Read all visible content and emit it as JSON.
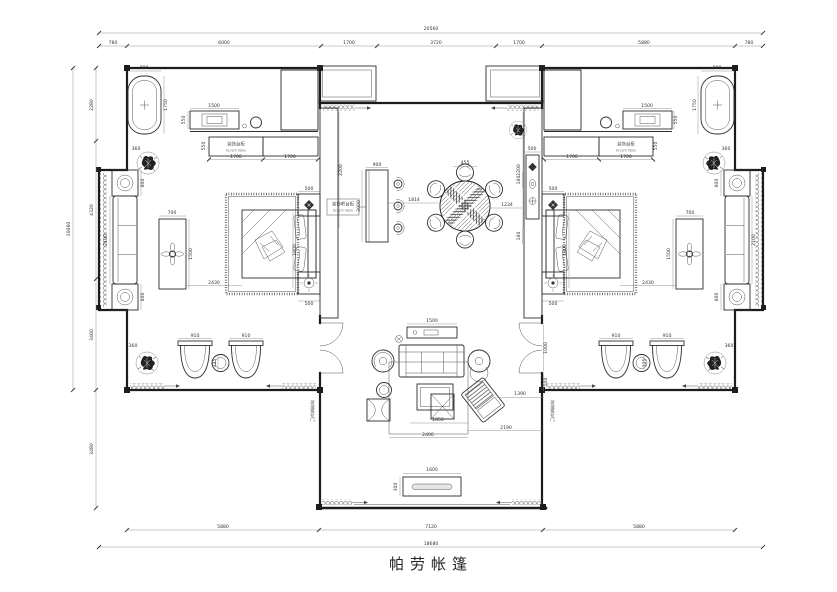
{
  "title": {
    "text": "帕劳帐篷"
  },
  "labels": {
    "accent_table_zh": "装饰台柜",
    "accent_table_en": "Accent Table",
    "bar_zh": "装饰吧台柜",
    "bar_en": "Accent Table",
    "glass_door": "玻璃推拉门"
  },
  "colors": {
    "line": "#1c1c1c",
    "dim_text": "#333333",
    "paper": "#ffffff"
  },
  "dimensions": {
    "top": {
      "total": "20560",
      "segments": [
        "780",
        "6000",
        "1700",
        "3720",
        "1700",
        "5880",
        "780"
      ]
    },
    "bottom": {
      "total": "18680",
      "segments": [
        "5880",
        "7120",
        "5880"
      ]
    },
    "left": {
      "total": "10060",
      "segments": [
        "2280",
        "4320",
        "3460"
      ],
      "lower": "3480"
    }
  },
  "dim_labels": [
    {
      "t": "20560",
      "x": 431,
      "y": 30
    },
    {
      "t": "780",
      "x": 113,
      "y": 44
    },
    {
      "t": "6000",
      "x": 224,
      "y": 44
    },
    {
      "t": "1700",
      "x": 349,
      "y": 44
    },
    {
      "t": "3720",
      "x": 436,
      "y": 44
    },
    {
      "t": "1700",
      "x": 519,
      "y": 44
    },
    {
      "t": "5880",
      "x": 644,
      "y": 44
    },
    {
      "t": "780",
      "x": 749,
      "y": 44
    },
    {
      "t": "5880",
      "x": 223,
      "y": 528
    },
    {
      "t": "7120",
      "x": 431,
      "y": 528
    },
    {
      "t": "5880",
      "x": 639,
      "y": 528
    },
    {
      "t": "18680",
      "x": 431,
      "y": 545
    },
    {
      "t": "2280",
      "x": 93,
      "y": 105,
      "r": 1
    },
    {
      "t": "4320",
      "x": 93,
      "y": 210,
      "r": 1
    },
    {
      "t": "3460",
      "x": 93,
      "y": 335,
      "r": 1
    },
    {
      "t": "10060",
      "x": 70,
      "y": 229,
      "r": 1
    },
    {
      "t": "3480",
      "x": 93,
      "y": 449,
      "r": 1
    },
    {
      "t": "800",
      "x": 144,
      "y": 69
    },
    {
      "t": "1750",
      "x": 167,
      "y": 105,
      "r": 1
    },
    {
      "t": "1500",
      "x": 214,
      "y": 107
    },
    {
      "t": "550",
      "x": 185,
      "y": 120,
      "r": 1
    },
    {
      "t": "1700",
      "x": 236,
      "y": 158
    },
    {
      "t": "1700",
      "x": 290,
      "y": 158
    },
    {
      "t": "550",
      "x": 205,
      "y": 146,
      "r": 1
    },
    {
      "t": "360",
      "x": 136,
      "y": 150
    },
    {
      "t": "600",
      "x": 144,
      "y": 183,
      "r": 1
    },
    {
      "t": "2100",
      "x": 107,
      "y": 240,
      "r": 1
    },
    {
      "t": "600",
      "x": 144,
      "y": 297,
      "r": 1
    },
    {
      "t": "700",
      "x": 172,
      "y": 214
    },
    {
      "t": "1500",
      "x": 192,
      "y": 254,
      "r": 1
    },
    {
      "t": "2430",
      "x": 214,
      "y": 284
    },
    {
      "t": "1800",
      "x": 296,
      "y": 250,
      "r": 1
    },
    {
      "t": "500",
      "x": 309,
      "y": 190
    },
    {
      "t": "500",
      "x": 309,
      "y": 305
    },
    {
      "t": "2200",
      "x": 342,
      "y": 170,
      "r": 1
    },
    {
      "t": "910",
      "x": 195,
      "y": 337
    },
    {
      "t": "910",
      "x": 246,
      "y": 337
    },
    {
      "t": "325",
      "x": 216,
      "y": 363,
      "r": 1
    },
    {
      "t": "360",
      "x": 133,
      "y": 347
    },
    {
      "t": "900",
      "x": 377,
      "y": 166
    },
    {
      "t": "3000",
      "x": 360,
      "y": 206,
      "r": 1
    },
    {
      "t": "1814",
      "x": 414,
      "y": 201
    },
    {
      "t": "455",
      "x": 465,
      "y": 164
    },
    {
      "t": "1234",
      "x": 507,
      "y": 206
    },
    {
      "t": "500",
      "x": 532,
      "y": 150
    },
    {
      "t": "160",
      "x": 520,
      "y": 180,
      "r": 1
    },
    {
      "t": "160",
      "x": 520,
      "y": 236,
      "r": 1
    },
    {
      "t": "1500",
      "x": 432,
      "y": 322
    },
    {
      "t": "1050",
      "x": 438,
      "y": 421
    },
    {
      "t": "2400",
      "x": 428,
      "y": 436
    },
    {
      "t": "2190",
      "x": 506,
      "y": 429
    },
    {
      "t": "1390",
      "x": 520,
      "y": 395
    },
    {
      "t": "1600",
      "x": 432,
      "y": 471
    },
    {
      "t": "300",
      "x": 397,
      "y": 487,
      "r": 1
    },
    {
      "t": "1000",
      "x": 547,
      "y": 348,
      "r": 1
    },
    {
      "t": "500",
      "x": 547,
      "y": 382,
      "r": 1
    },
    {
      "t": "800",
      "x": 717,
      "y": 69
    },
    {
      "t": "1750",
      "x": 696,
      "y": 105,
      "r": 1
    },
    {
      "t": "1500",
      "x": 647,
      "y": 107
    },
    {
      "t": "550",
      "x": 677,
      "y": 120,
      "r": 1
    },
    {
      "t": "1700",
      "x": 626,
      "y": 158
    },
    {
      "t": "1700",
      "x": 572,
      "y": 158
    },
    {
      "t": "550",
      "x": 657,
      "y": 146,
      "r": 1
    },
    {
      "t": "360",
      "x": 726,
      "y": 150
    },
    {
      "t": "600",
      "x": 718,
      "y": 183,
      "r": 1
    },
    {
      "t": "2100",
      "x": 755,
      "y": 240,
      "r": 1
    },
    {
      "t": "600",
      "x": 718,
      "y": 297,
      "r": 1
    },
    {
      "t": "700",
      "x": 690,
      "y": 214
    },
    {
      "t": "1500",
      "x": 670,
      "y": 254,
      "r": 1
    },
    {
      "t": "2430",
      "x": 648,
      "y": 284
    },
    {
      "t": "1800",
      "x": 566,
      "y": 250,
      "r": 1
    },
    {
      "t": "500",
      "x": 553,
      "y": 190
    },
    {
      "t": "500",
      "x": 553,
      "y": 305
    },
    {
      "t": "2200",
      "x": 520,
      "y": 170,
      "r": 1
    },
    {
      "t": "910",
      "x": 616,
      "y": 337
    },
    {
      "t": "910",
      "x": 667,
      "y": 337
    },
    {
      "t": "325",
      "x": 646,
      "y": 363,
      "r": 1
    },
    {
      "t": "360",
      "x": 729,
      "y": 347
    }
  ]
}
